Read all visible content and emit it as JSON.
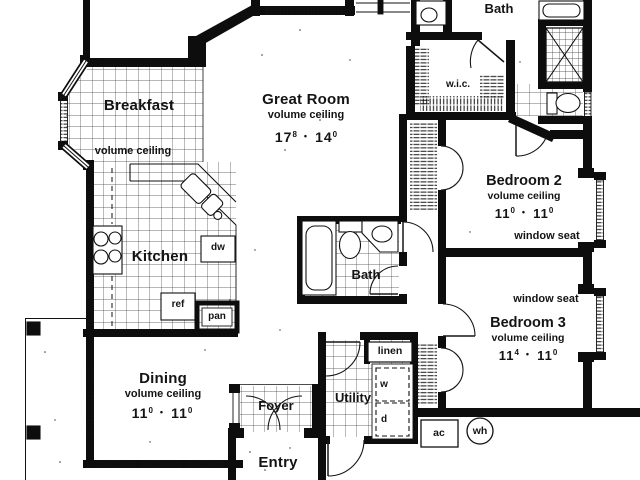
{
  "rooms": {
    "breakfast": {
      "name": "Breakfast",
      "ceiling": "volume ceiling"
    },
    "great_room": {
      "name": "Great Room",
      "ceiling": "volume ceiling",
      "dim": {
        "a": "17",
        "a_sup": "8",
        "sep": "•",
        "b": "14",
        "b_sup": "0"
      }
    },
    "kitchen": {
      "name": "Kitchen"
    },
    "dining": {
      "name": "Dining",
      "ceiling": "volume ceiling",
      "dim": {
        "a": "11",
        "a_sup": "0",
        "sep": "•",
        "b": "11",
        "b_sup": "0"
      }
    },
    "foyer": {
      "name": "Foyer"
    },
    "utility": {
      "name": "Utility"
    },
    "entry": {
      "name": "Entry"
    },
    "upper_bath": {
      "name": "Bath"
    },
    "hall_bath": {
      "name": "Bath"
    },
    "wic": {
      "name": "w.i.c."
    },
    "bedroom_2": {
      "name": "Bedroom 2",
      "ceiling": "volume ceiling",
      "dim": {
        "a": "11",
        "a_sup": "0",
        "sep": "•",
        "b": "11",
        "b_sup": "0"
      },
      "feature": "window seat"
    },
    "bedroom_3": {
      "name": "Bedroom 3",
      "ceiling": "volume ceiling",
      "dim": {
        "a": "11",
        "a_sup": "4",
        "sep": "•",
        "b": "11",
        "b_sup": "0"
      },
      "feature": "window seat"
    }
  },
  "labels": {
    "dishwasher": "dw",
    "refrigerator": "ref",
    "pantry": "pan",
    "linen": "linen",
    "washer": "w",
    "dryer": "d",
    "air_handler": "ac",
    "water_heater": "wh"
  },
  "colors": {
    "ink": "#141414",
    "paper": "#ffffff"
  }
}
